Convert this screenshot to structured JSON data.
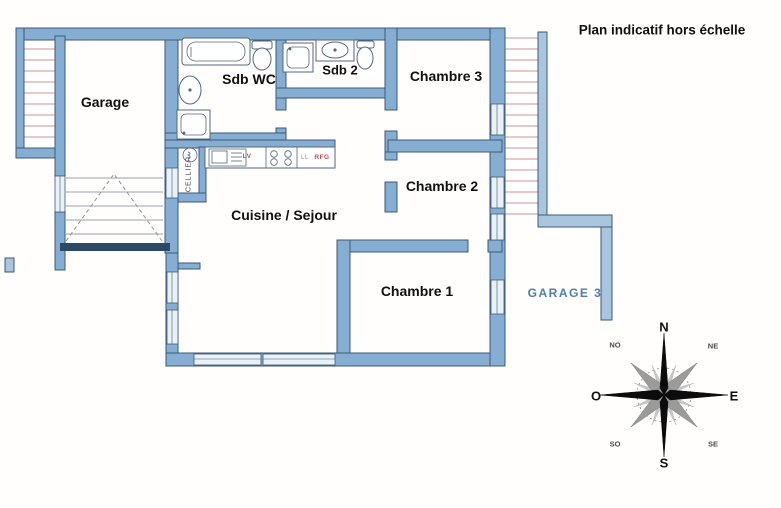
{
  "title": "Plan indicatif hors échelle",
  "rooms": {
    "garage": "Garage",
    "sdb_wc": "Sdb WC",
    "sdb2": "Sdb 2",
    "chambre3": "Chambre 3",
    "chambre2": "Chambre 2",
    "chambre1": "Chambre 1",
    "cuisine_sejour": "Cuisine / Sejour",
    "cellier": "CELLIER",
    "garage3": "GARAGE 3"
  },
  "appliances": {
    "lv": "LV",
    "ll": "LL",
    "rfg": "RFG"
  },
  "compass": {
    "n": "N",
    "no": "NO",
    "ne": "NE",
    "o": "O",
    "e": "E",
    "so": "SO",
    "se": "SE",
    "s": "S"
  },
  "palette": {
    "wall": "#85aed2",
    "wall_light": "#a9c6de",
    "wall_outline": "#3d5a78",
    "door_bar": "#2c4a68",
    "window_fill": "#e9f0f6",
    "hatch_line": "#cc9494",
    "fixture_outline": "#55677a",
    "appliance_text": "#c14b4b",
    "appliance_gray": "#8a8f98",
    "garage3_text": "#4f7dab"
  }
}
